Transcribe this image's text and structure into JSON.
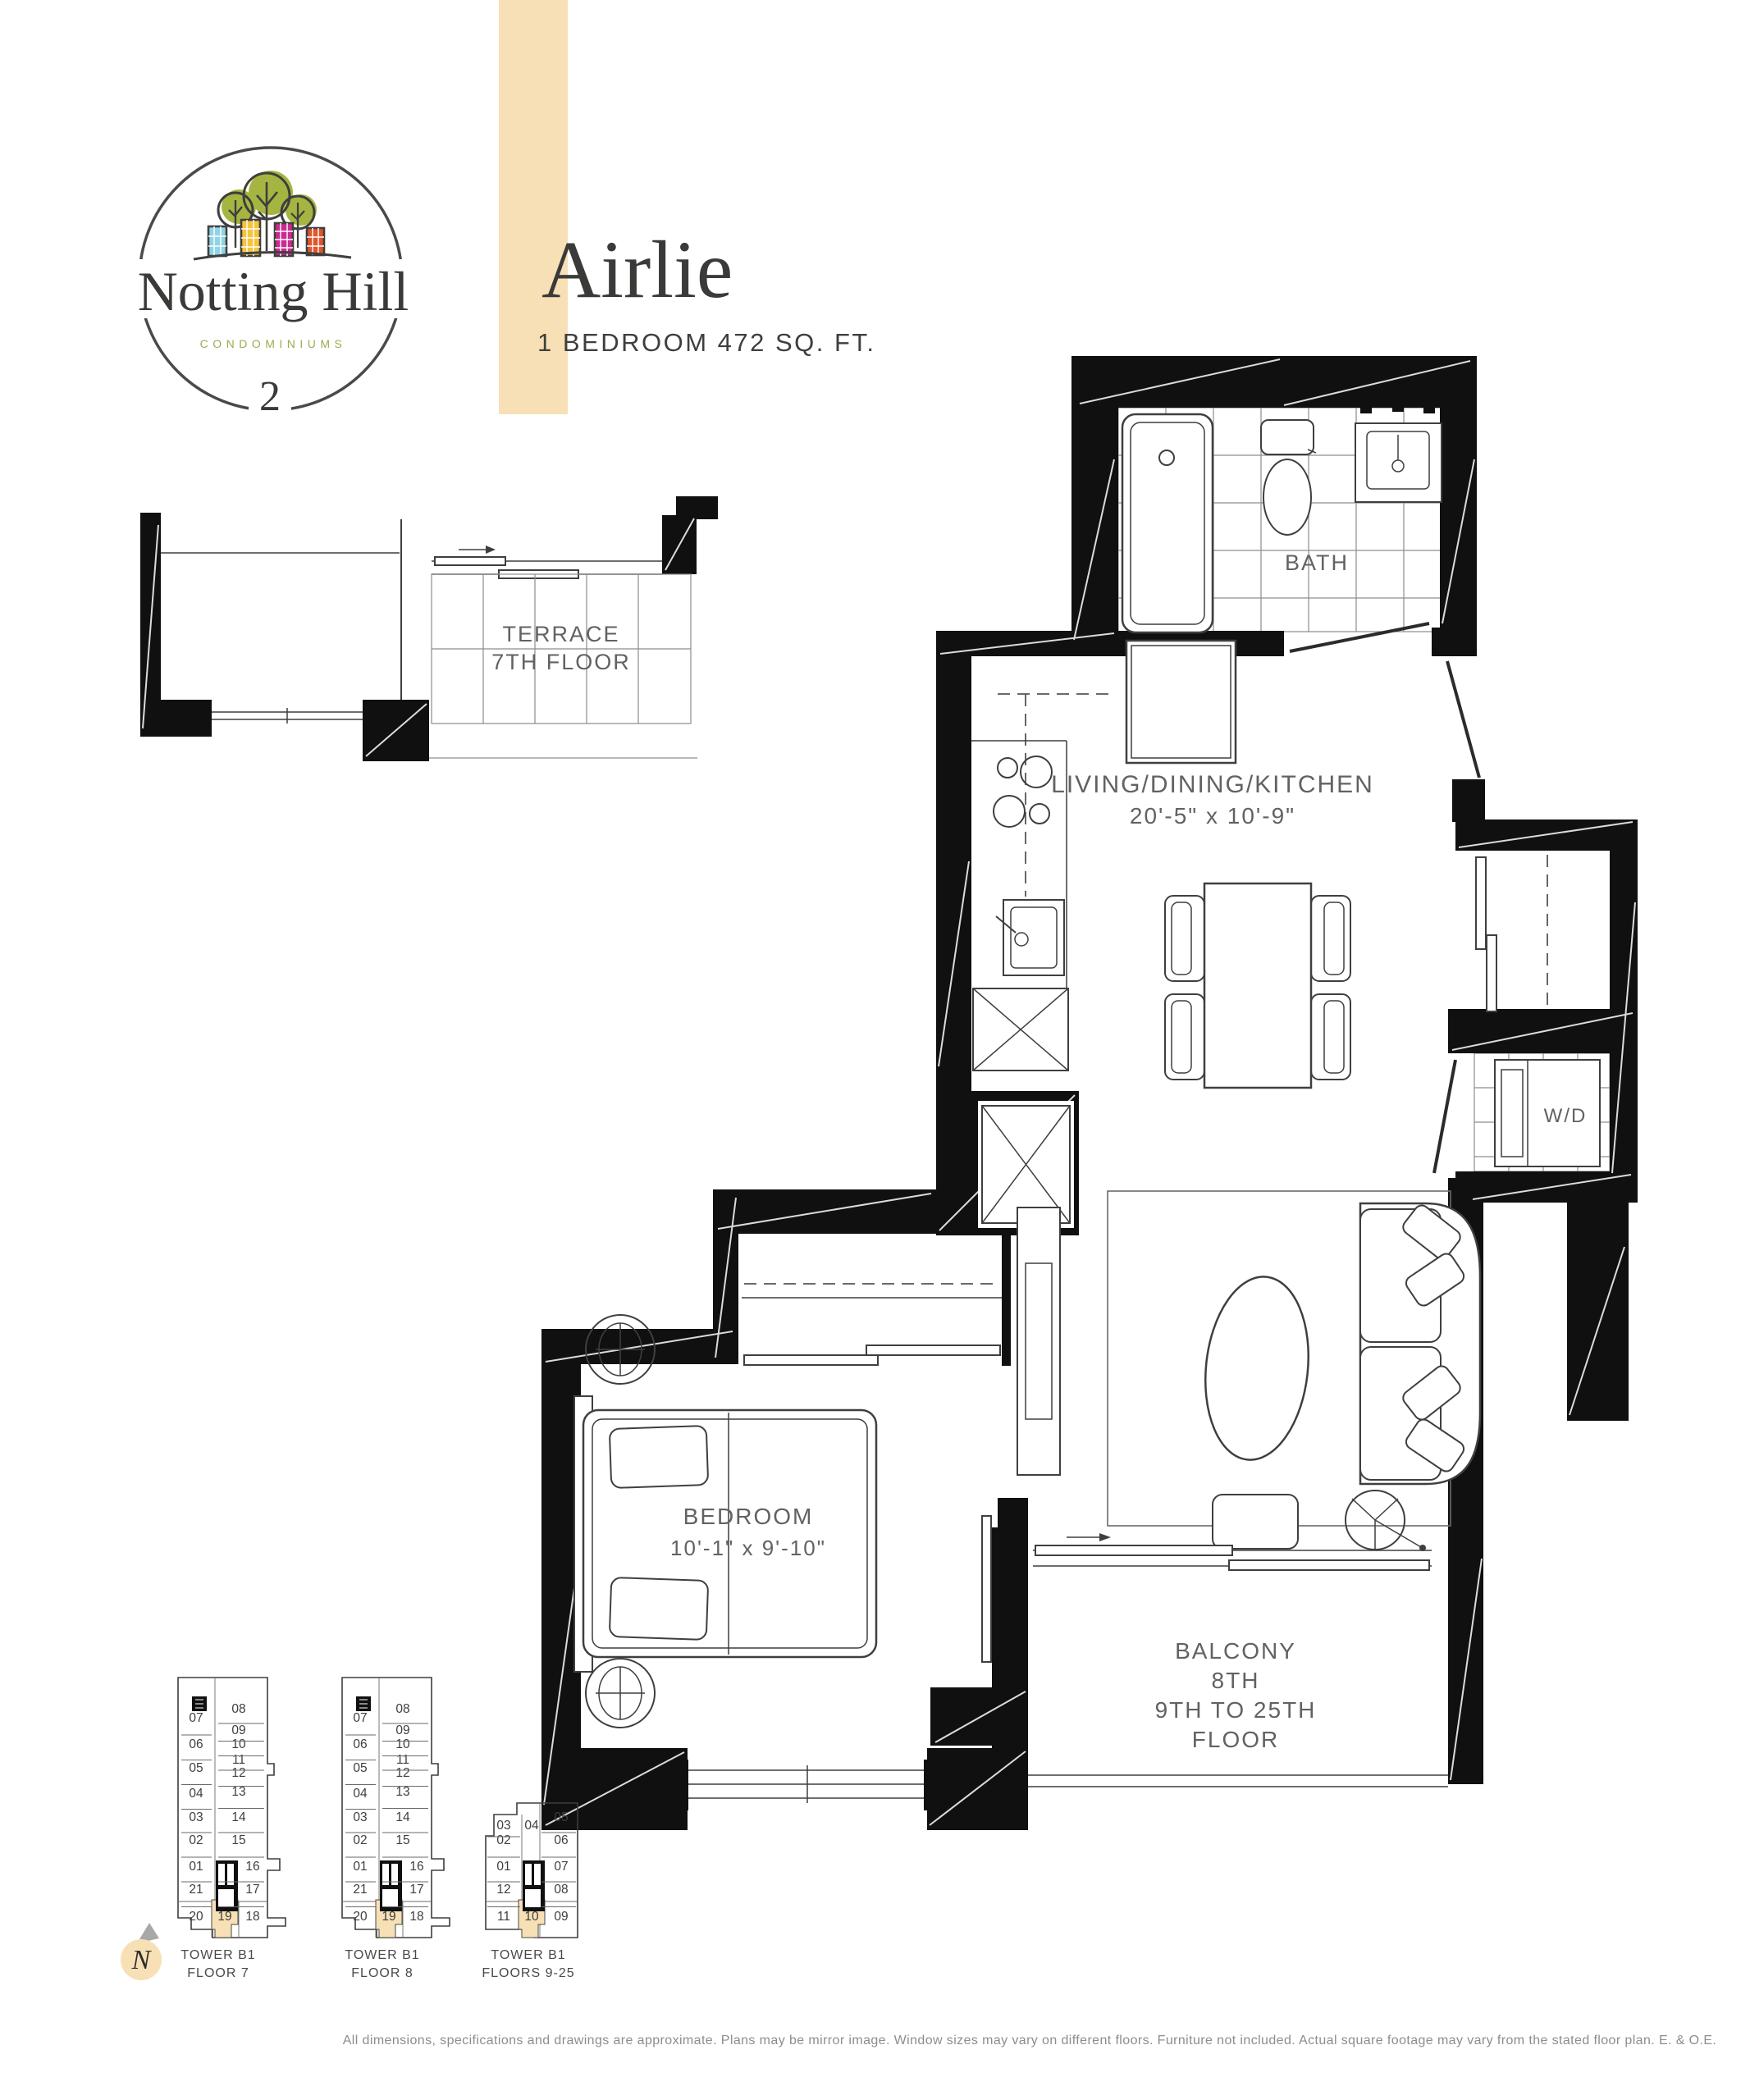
{
  "header": {
    "logo": {
      "name": "Notting Hill",
      "tagline": "CONDOMINIUMS",
      "phase": "2"
    },
    "title": "Airlie",
    "subtitle": "1 BEDROOM  472 SQ. FT."
  },
  "plan": {
    "terrace": {
      "line1": "TERRACE",
      "line2": "7TH FLOOR"
    },
    "bath": {
      "label": "BATH"
    },
    "living": {
      "line1": "LIVING/DINING/KITCHEN",
      "line2": "20'-5\" x 10'-9\""
    },
    "laundry": {
      "label": "W/D"
    },
    "bedroom": {
      "line1": "BEDROOM",
      "line2": "10'-1\"  x  9'-10\""
    },
    "balcony": {
      "line1": "BALCONY",
      "line2": "8TH",
      "line3": "9TH TO 25TH",
      "line4": "FLOOR"
    }
  },
  "keyplans": [
    {
      "name": "TOWER B1",
      "floor": "FLOOR 7",
      "left_units": [
        "07",
        "06",
        "05",
        "04",
        "03",
        "02",
        "01",
        "21",
        "20"
      ],
      "right_units": [
        "08",
        "09",
        "10",
        "11",
        "12",
        "13",
        "14",
        "15",
        "16",
        "17",
        "18"
      ],
      "highlight": "19"
    },
    {
      "name": "TOWER B1",
      "floor": "FLOOR 8",
      "left_units": [
        "07",
        "06",
        "05",
        "04",
        "03",
        "02",
        "01",
        "21",
        "20"
      ],
      "right_units": [
        "08",
        "09",
        "10",
        "11",
        "12",
        "13",
        "14",
        "15",
        "16",
        "17",
        "18"
      ],
      "highlight": "19"
    },
    {
      "name": "TOWER B1",
      "floor": "FLOORS 9-25",
      "left_units": [
        "03",
        "02",
        "01",
        "12",
        "11"
      ],
      "right_units": [
        "05",
        "06",
        "07",
        "08",
        "09"
      ],
      "top_unit": "04",
      "highlight": "10"
    }
  ],
  "compass": {
    "label": "N"
  },
  "disclaimer": "All dimensions, specifications and drawings are approximate. Plans may be mirror image. Window sizes may vary on different floors. Furniture not included. Actual square footage may vary from the stated floor plan. E. & O.E.",
  "colors": {
    "accent_beige": "#F7E0B6",
    "olive": "#A0AA4F",
    "tree_green": "#A6B541",
    "building_blue": "#8FD4E5",
    "building_yellow": "#F4C43B",
    "building_magenta": "#CB2A90",
    "building_orange": "#E2552C",
    "wall_black": "#101010",
    "label_gray": "#626265"
  }
}
